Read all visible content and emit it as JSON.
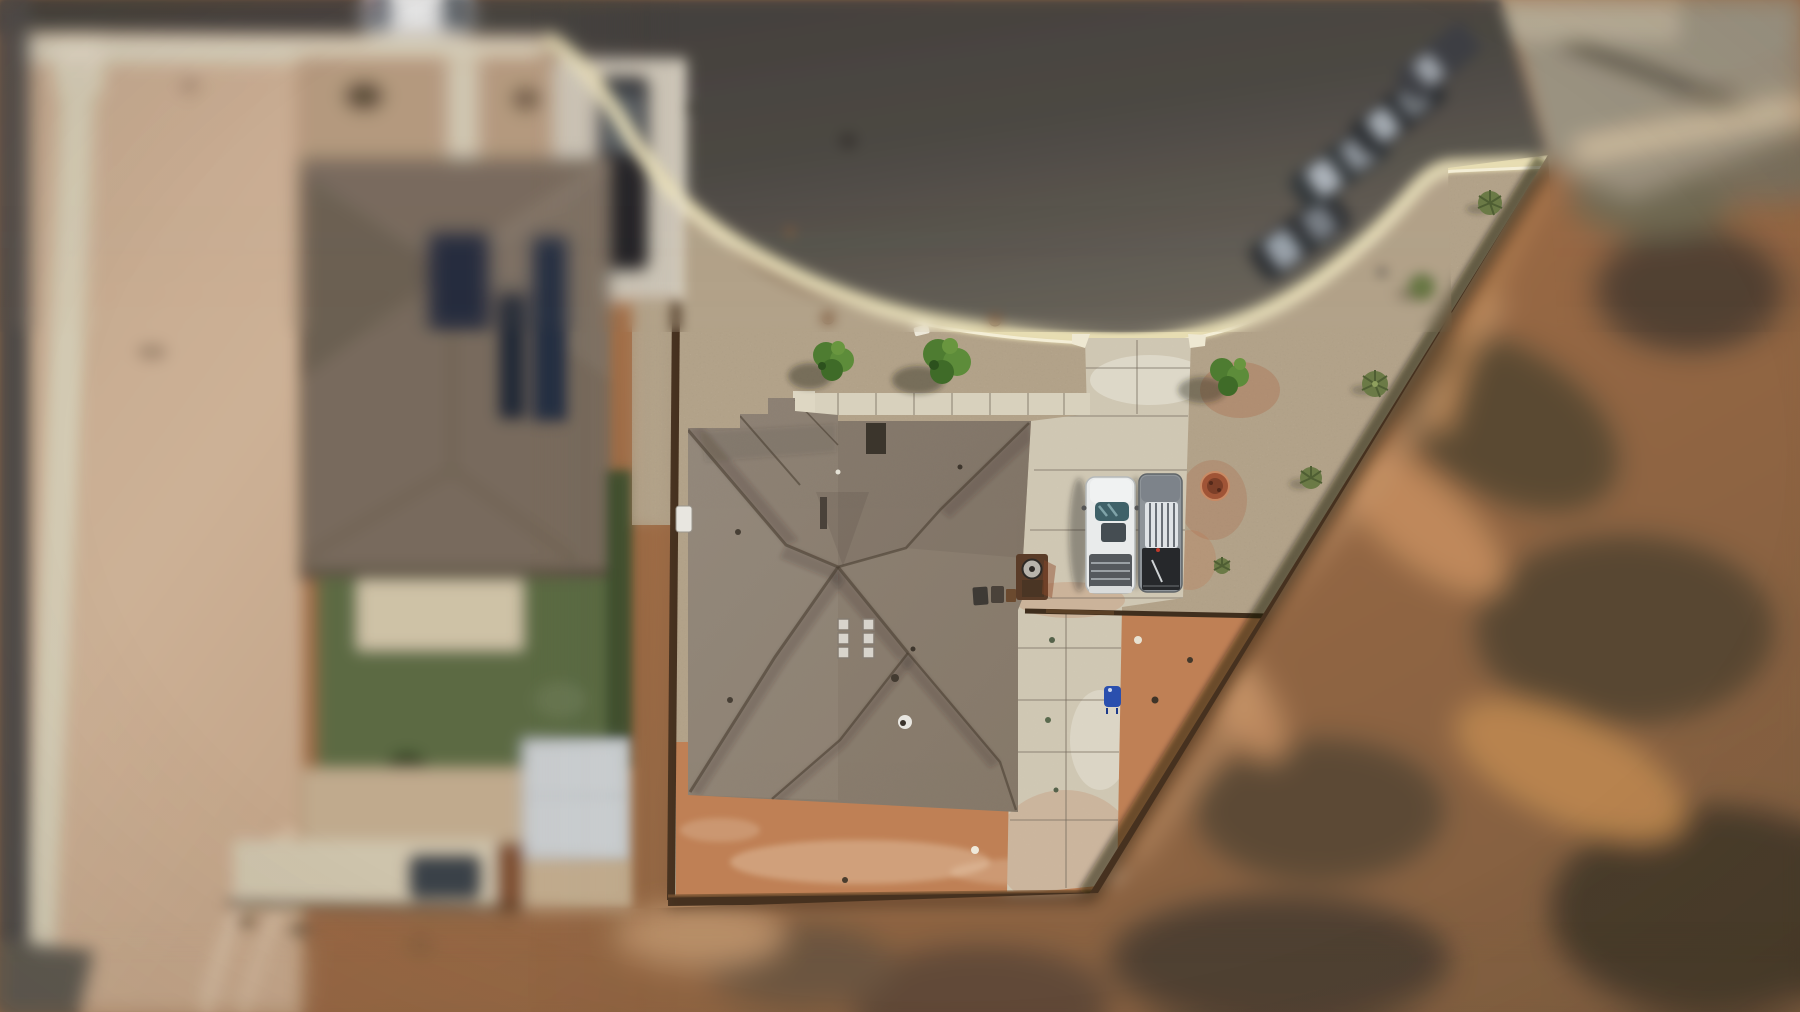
{
  "canvas": {
    "width": 1800,
    "height": 1012
  },
  "scene": {
    "type": "aerial-drone-photo",
    "style": "tilt-shift, sharp center focus, blurred edges",
    "objects": [
      {
        "name": "cul-de-sac-road",
        "position": "top",
        "surface": "dark asphalt",
        "curb": "cream concrete curve"
      },
      {
        "name": "main-house-roof",
        "position": "center",
        "material": "gray-taupe shingles, hip roof",
        "vents": 6
      },
      {
        "name": "front-sidewalk",
        "position": "above house",
        "material": "concrete tiles"
      },
      {
        "name": "driveway-and-pad",
        "position": "right of house",
        "material": "concrete"
      },
      {
        "name": "white-pickup-truck",
        "position": "driveway"
      },
      {
        "name": "gray-pickup-truck",
        "position": "driveway"
      },
      {
        "name": "street-parked-cars",
        "count": 4,
        "position": "top-right curb"
      },
      {
        "name": "white-car-street",
        "position": "top-left road edge"
      },
      {
        "name": "neighbor-house",
        "position": "left",
        "roof": "brown shingles",
        "solar_panels": 3,
        "lawn": true,
        "shed": true,
        "dark-car": 2
      },
      {
        "name": "gravel-xeriscape-yard",
        "shrubs": 3,
        "yuccas": 5,
        "rocks": 2
      },
      {
        "name": "fire-pit-ring",
        "position": "right of driveway",
        "color": "rust"
      },
      {
        "name": "wood-fences",
        "segments": [
          "left",
          "bottom",
          "back horizontal",
          "long diagonal right"
        ]
      },
      {
        "name": "red-dirt-slope",
        "position": "right",
        "texture": "scrub brush blobs"
      },
      {
        "name": "red-dirt-backyard",
        "position": "below house"
      },
      {
        "name": "dirt-lot",
        "position": "far left"
      },
      {
        "name": "trash-bins",
        "count": 2,
        "position": "house corner"
      },
      {
        "name": "blue-chair",
        "position": "rear concrete pad"
      }
    ]
  },
  "palette": {
    "road": "#474440",
    "roadLight": "#6d6860",
    "roadDark": "#3a3936",
    "curb": "#e7ddb2",
    "curbLine": "#f6f1da",
    "gravel": "#b2a289",
    "gravelDark": "#8c7d67",
    "gravelLight": "#d8cdb6",
    "concrete": "#cfc7b3",
    "concreteLight": "#e9e3d3",
    "sidewalk": "#d8d1bd",
    "roof": "#8b7f73",
    "roofLight": "#9b8f82",
    "ridge": "#57492e",
    "redDirt": "#bf8055",
    "redDirtLight": "#e2ac80",
    "slope": "#a86c45",
    "slopeDark": "#554634",
    "slopeLight": "#c38d5e",
    "dirtLot": "#c9ae92",
    "dirtLotLight": "#dcc4aa",
    "darkStrip": "#4b4a46",
    "lawn": "#5a6a42",
    "patio": "#cfc3a7",
    "shed": "#c9cdcf",
    "neighborRoof": "#776a5b",
    "solar": "#202c3e",
    "fence": "#46311f",
    "fenceRust": "#8a5a33",
    "truckWhite": "#e9ebeb",
    "truckGray": "#8e9499",
    "glassTeal": "#3f6168",
    "bedDark": "#55595d",
    "bedBlack": "#26282b",
    "chairBlue": "#2a4fae",
    "bushGreen": "#4e7c31",
    "bushGreen2": "#5d8c3a",
    "bushDark": "#3f6b28",
    "yucca": "#6b7a46",
    "firePit": "#a05436"
  }
}
